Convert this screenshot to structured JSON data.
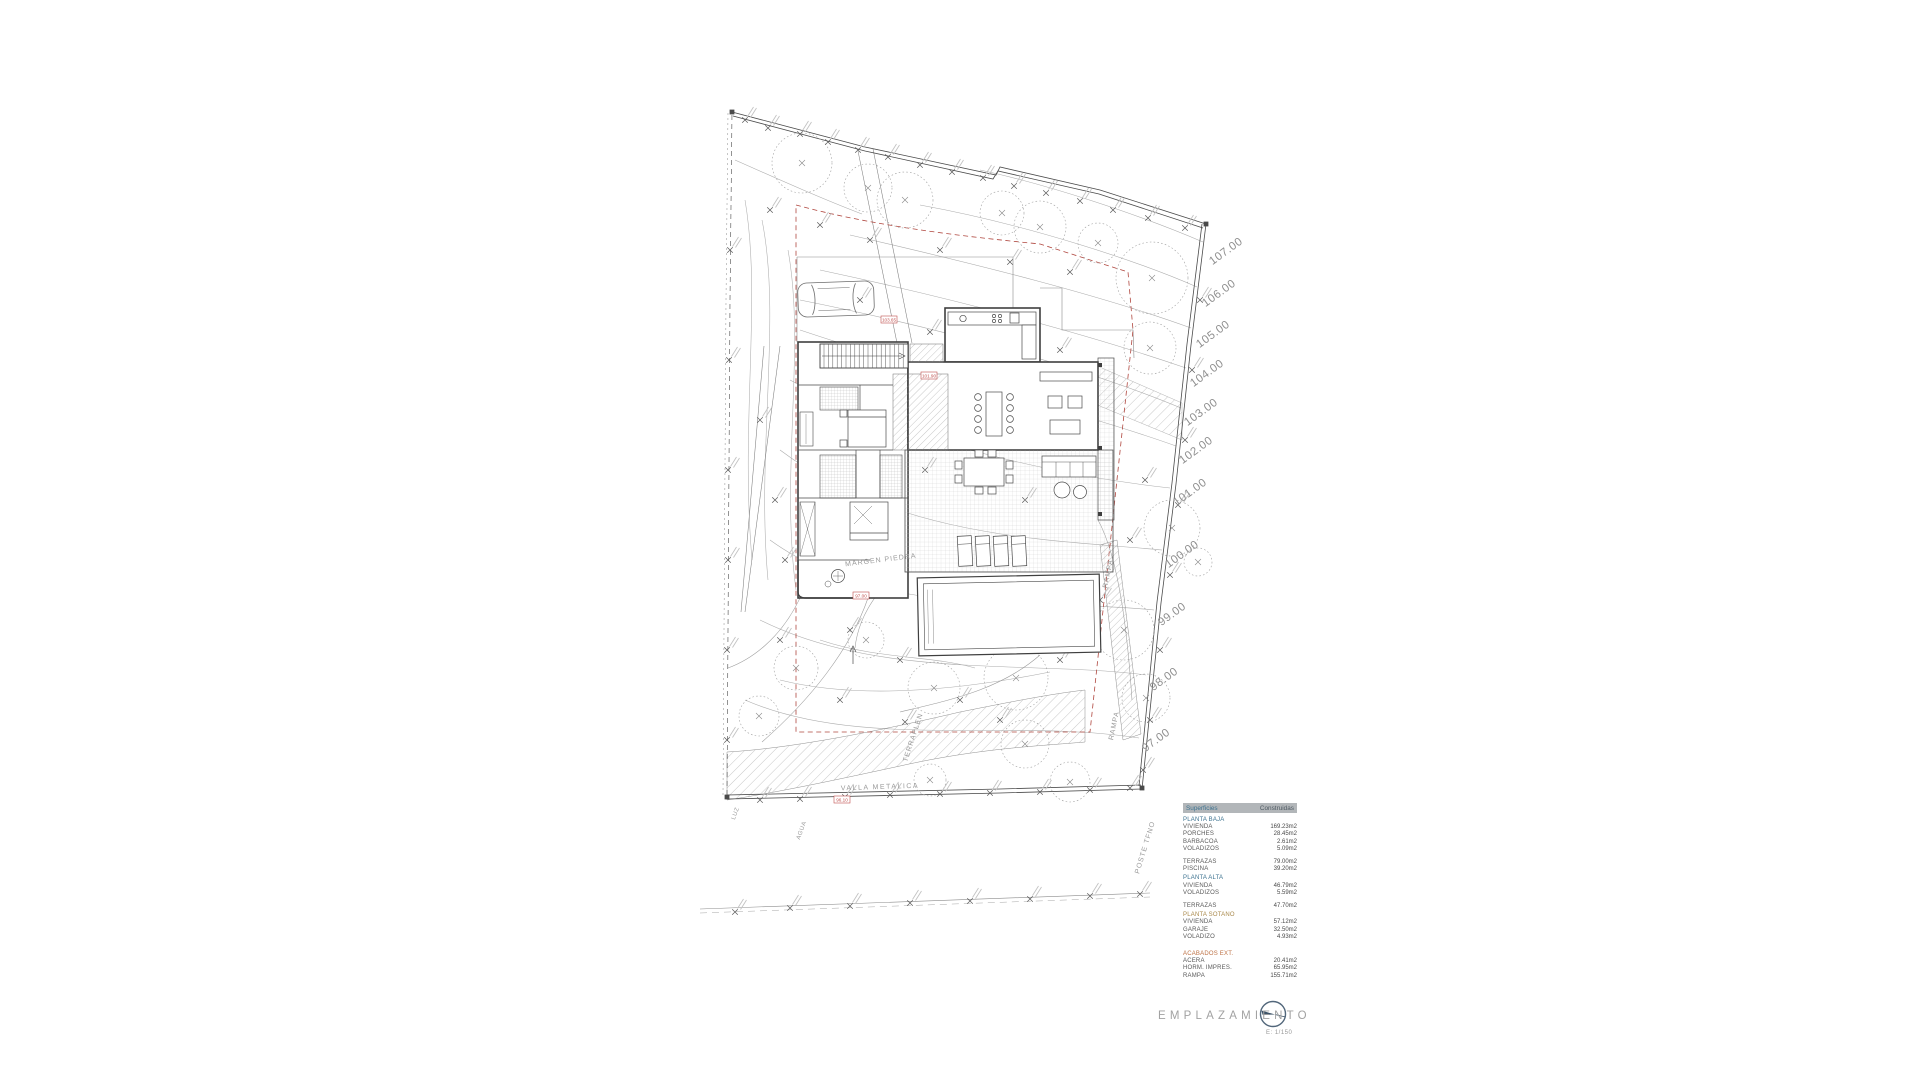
{
  "colors": {
    "wall": "#3f3f3f",
    "thin_line": "#8c8c8c",
    "contour": "#ababab",
    "setback_red": "#b0473f",
    "label_gray": "#9a9a9a",
    "table_header_bg": "#b2b6b9",
    "section_teal": "#3d7390",
    "section_tan": "#a9894b",
    "section_orange": "#bd7144",
    "compass_blue": "#3e5468"
  },
  "plan": {
    "elevation_labels": [
      {
        "t": "107.00",
        "x": 1228,
        "y": 254
      },
      {
        "t": "106.00",
        "x": 1221,
        "y": 296
      },
      {
        "t": "105.00",
        "x": 1215,
        "y": 337
      },
      {
        "t": "104.00",
        "x": 1209,
        "y": 376
      },
      {
        "t": "103.00",
        "x": 1203,
        "y": 415
      },
      {
        "t": "102.00",
        "x": 1198,
        "y": 453
      },
      {
        "t": "101.00",
        "x": 1192,
        "y": 495
      },
      {
        "t": "100.00",
        "x": 1184,
        "y": 557
      },
      {
        "t": "99.00",
        "x": 1174,
        "y": 617
      },
      {
        "t": "98.00",
        "x": 1166,
        "y": 682
      },
      {
        "t": "97.00",
        "x": 1158,
        "y": 743
      }
    ],
    "labels": [
      {
        "t": "VALLA METALICA",
        "x": 880,
        "y": 789,
        "r": -2,
        "s": 7,
        "sp": 1.5
      },
      {
        "t": "POSTE TFNO",
        "x": 1147,
        "y": 848,
        "r": -73,
        "s": 7,
        "sp": 1
      },
      {
        "t": "LUZ",
        "x": 737,
        "y": 814,
        "r": -70,
        "s": 6,
        "sp": 0.5
      },
      {
        "t": "AGUA",
        "x": 803,
        "y": 831,
        "r": -70,
        "s": 6,
        "sp": 0.5
      },
      {
        "t": "TERRAPLEN",
        "x": 915,
        "y": 738,
        "r": -72,
        "s": 7,
        "sp": 1
      },
      {
        "t": "RAMPA",
        "x": 1110,
        "y": 574,
        "r": -78,
        "s": 7,
        "sp": 1
      },
      {
        "t": "RAMPA",
        "x": 1116,
        "y": 726,
        "r": -78,
        "s": 7,
        "sp": 1
      },
      {
        "t": "MARGEN PIEDRA",
        "x": 881,
        "y": 562,
        "r": -7,
        "s": 7,
        "sp": 1
      }
    ],
    "level_boxes": [
      {
        "t": "103.65",
        "x": 889,
        "y": 320
      },
      {
        "t": "101.90",
        "x": 929,
        "y": 376
      },
      {
        "t": "97.00",
        "x": 861,
        "y": 596
      },
      {
        "t": "96.10",
        "x": 842,
        "y": 800
      }
    ]
  },
  "areas_table": {
    "headers": [
      "Superficies",
      "Construidas"
    ],
    "rows": [
      {
        "type": "s1",
        "label": "PLANTA BAJA",
        "value": ""
      },
      {
        "type": "item",
        "label": "VIVIENDA",
        "value": "169.23m2"
      },
      {
        "type": "item",
        "label": "PORCHES",
        "value": "28.45m2"
      },
      {
        "type": "item",
        "label": "BARBACOA",
        "value": "2.61m2"
      },
      {
        "type": "item",
        "label": "VOLADIZOS",
        "value": "5.09m2"
      },
      {
        "type": "item",
        "label": "TERRAZAS",
        "value": "79.00m2",
        "gap": 6
      },
      {
        "type": "item",
        "label": "PISCINA",
        "value": "39.20m2"
      },
      {
        "type": "s1",
        "label": "PLANTA ALTA",
        "value": "",
        "gap": 2
      },
      {
        "type": "item",
        "label": "VIVIENDA",
        "value": "46.79m2"
      },
      {
        "type": "item",
        "label": "VOLADIZOS",
        "value": "5.59m2"
      },
      {
        "type": "item",
        "label": "TERRAZAS",
        "value": "47.70m2",
        "gap": 6
      },
      {
        "type": "s2",
        "label": "PLANTA SOTANO",
        "value": "",
        "gap": 2
      },
      {
        "type": "item",
        "label": "VIVIENDA",
        "value": "57.12m2"
      },
      {
        "type": "item",
        "label": "GARAJE",
        "value": "32.50m2"
      },
      {
        "type": "item",
        "label": "VOLADIZO",
        "value": "4.93m2"
      },
      {
        "type": "s3",
        "label": "ACABADOS EXT.",
        "value": "",
        "gap": 10
      },
      {
        "type": "item",
        "label": "ACERA",
        "value": "20.41m2"
      },
      {
        "type": "item",
        "label": "HORM. IMPRES.",
        "value": "65.95m2"
      },
      {
        "type": "item",
        "label": "RAMPA",
        "value": "155.71m2"
      }
    ]
  },
  "title_block": {
    "title": "EMPLAZAMIENTO",
    "scale": "E: 1/150"
  }
}
